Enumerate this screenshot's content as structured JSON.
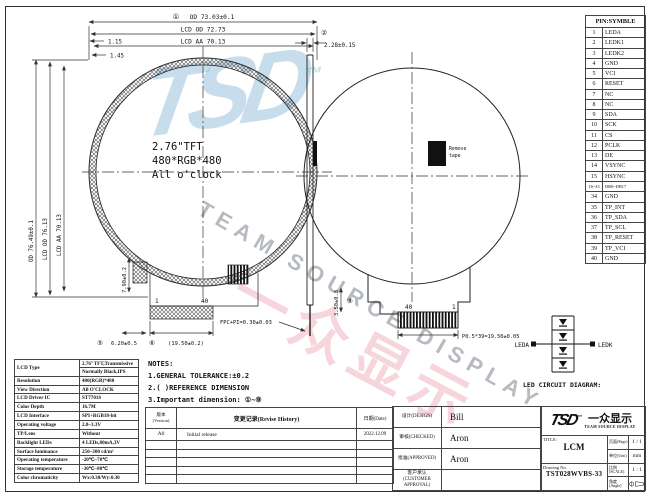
{
  "watermark": {
    "logo": "TSD",
    "tm": "™",
    "cn": "一众显示",
    "arc": "TEAM SOURCE DISPLAY"
  },
  "fv": {
    "c1": "2.76\"TFT",
    "c2": "480*RGB*480",
    "c3": "All o'clock",
    "d_od_b": "①",
    "d_od": "OD 73.03±0.1",
    "d_lcd": "LCD OD 72.73",
    "d_aa": "LCD AA 70.13",
    "d_v_od": "OD 76.49±0.1",
    "d_v_lcd": "LCD OD 76.13",
    "d_v_aa": "LCD AA 70.13",
    "d_s1": "1.15",
    "d_s2": "1.45",
    "pin_a": "1",
    "pin_b": "40",
    "d_b1_b": "⑤",
    "d_b1": "6.20±0.5",
    "d_b2_b": "⑥",
    "d_b2": "(19.50±0.2)",
    "d_tail": "7.90±0.2"
  },
  "sv": {
    "b": "②",
    "d": "2.28±0.15",
    "fpc": "FPC+PI=0.30±0.03"
  },
  "bv": {
    "pin_a": "40",
    "pin_b": "1",
    "d_pitch": "P0.5*39=19.50±0.05",
    "d_side_b": "⑨",
    "d_side": "3.50±0.3",
    "tape1": "Remove",
    "tape2": "tape"
  },
  "led": {
    "caption": "LED CIRCUIT DIAGRAM:",
    "a": "LEDA",
    "k": "LEDK"
  },
  "pin_table": {
    "header": "PIN:SYMBLE",
    "rows": [
      [
        "1",
        "LEDA"
      ],
      [
        "2",
        "LEDK1"
      ],
      [
        "3",
        "LEDK2"
      ],
      [
        "4",
        "GND"
      ],
      [
        "5",
        "VCI"
      ],
      [
        "6",
        "RESET"
      ],
      [
        "7",
        "NC"
      ],
      [
        "8",
        "NC"
      ],
      [
        "9",
        "SDA"
      ],
      [
        "10",
        "SCK"
      ],
      [
        "11",
        "CS"
      ],
      [
        "12",
        "PCLK"
      ],
      [
        "13",
        "DE"
      ],
      [
        "14",
        "VSYNC"
      ],
      [
        "15",
        "HSYNC"
      ],
      [
        "16~33",
        "DB0~DB17"
      ],
      [
        "34",
        "GND"
      ],
      [
        "35",
        "TP_INT"
      ],
      [
        "36",
        "TP_SDA"
      ],
      [
        "37",
        "TP_SCL"
      ],
      [
        "38",
        "TP_RESET"
      ],
      [
        "39",
        "TP_VCI"
      ],
      [
        "40",
        "GND"
      ]
    ]
  },
  "spec_table": {
    "lcd_label": "LCD Type",
    "lcd_v1": "2.76\"TFT,Transmissive",
    "lcd_v2": "Normally Black,IPS",
    "rows": [
      [
        "Resolution",
        "480(RGB)*480"
      ],
      [
        "View Direction",
        "All O'CLOCK"
      ],
      [
        "LCD Driver IC",
        "ST7701S"
      ],
      [
        "Color Depth",
        "16.7M"
      ],
      [
        "LCD Interface",
        "SPI+RGB18-bit"
      ],
      [
        "Operating voltage",
        "2.8~3.3V"
      ],
      [
        "TP/Lens",
        "Without"
      ],
      [
        "Backlight LEDs",
        "4 LEDs,80mA,3V"
      ],
      [
        "Surface luminance",
        "250~300 cd/m²"
      ],
      [
        "Operating temperature",
        "-20℃~70℃"
      ],
      [
        "Storage temperature",
        "-30℃~80℃"
      ],
      [
        "Color chromaticity",
        "Wx:0.30/Wy:0.30"
      ]
    ]
  },
  "notes": {
    "title": "NOTES:",
    "n1": "1.GENERAL TOLERANCE:±0.2",
    "n2": "2.( )REFERENCE DIMENSION",
    "n3": "3.Important dimension: ①~⑨"
  },
  "revision": {
    "h_version_cn": "版本",
    "h_version_en": "(Version)",
    "h_history": "变更记录(Revise History)",
    "h_date": "日期(Date)",
    "rows": [
      [
        "A0",
        "Initial release",
        "2022.12.09"
      ]
    ],
    "empty_rows": 5
  },
  "sign": {
    "design_l": "设计(DESIGN)",
    "design": "Bill",
    "check_l": "审核(CHECKED)",
    "check": "Aron",
    "appr_l": "批准(APPROVED)",
    "appr": "Aron",
    "cust_l1": "客户承认",
    "cust_l2": "(CUSTOMER APPROVAL)",
    "cust": ""
  },
  "tb": {
    "title_l": "TITLE:",
    "title": "LCM",
    "dwg_l": "Drawing No.",
    "dwg": "TST028WVBS-33",
    "page_l": "页面(Page)",
    "page": "1 / 1",
    "unit_l": "单位(Unit)",
    "unit": "mm",
    "scale_l": "比例(SCALE)",
    "scale": "1 : 1",
    "angle_l": "角度(Angle)"
  }
}
